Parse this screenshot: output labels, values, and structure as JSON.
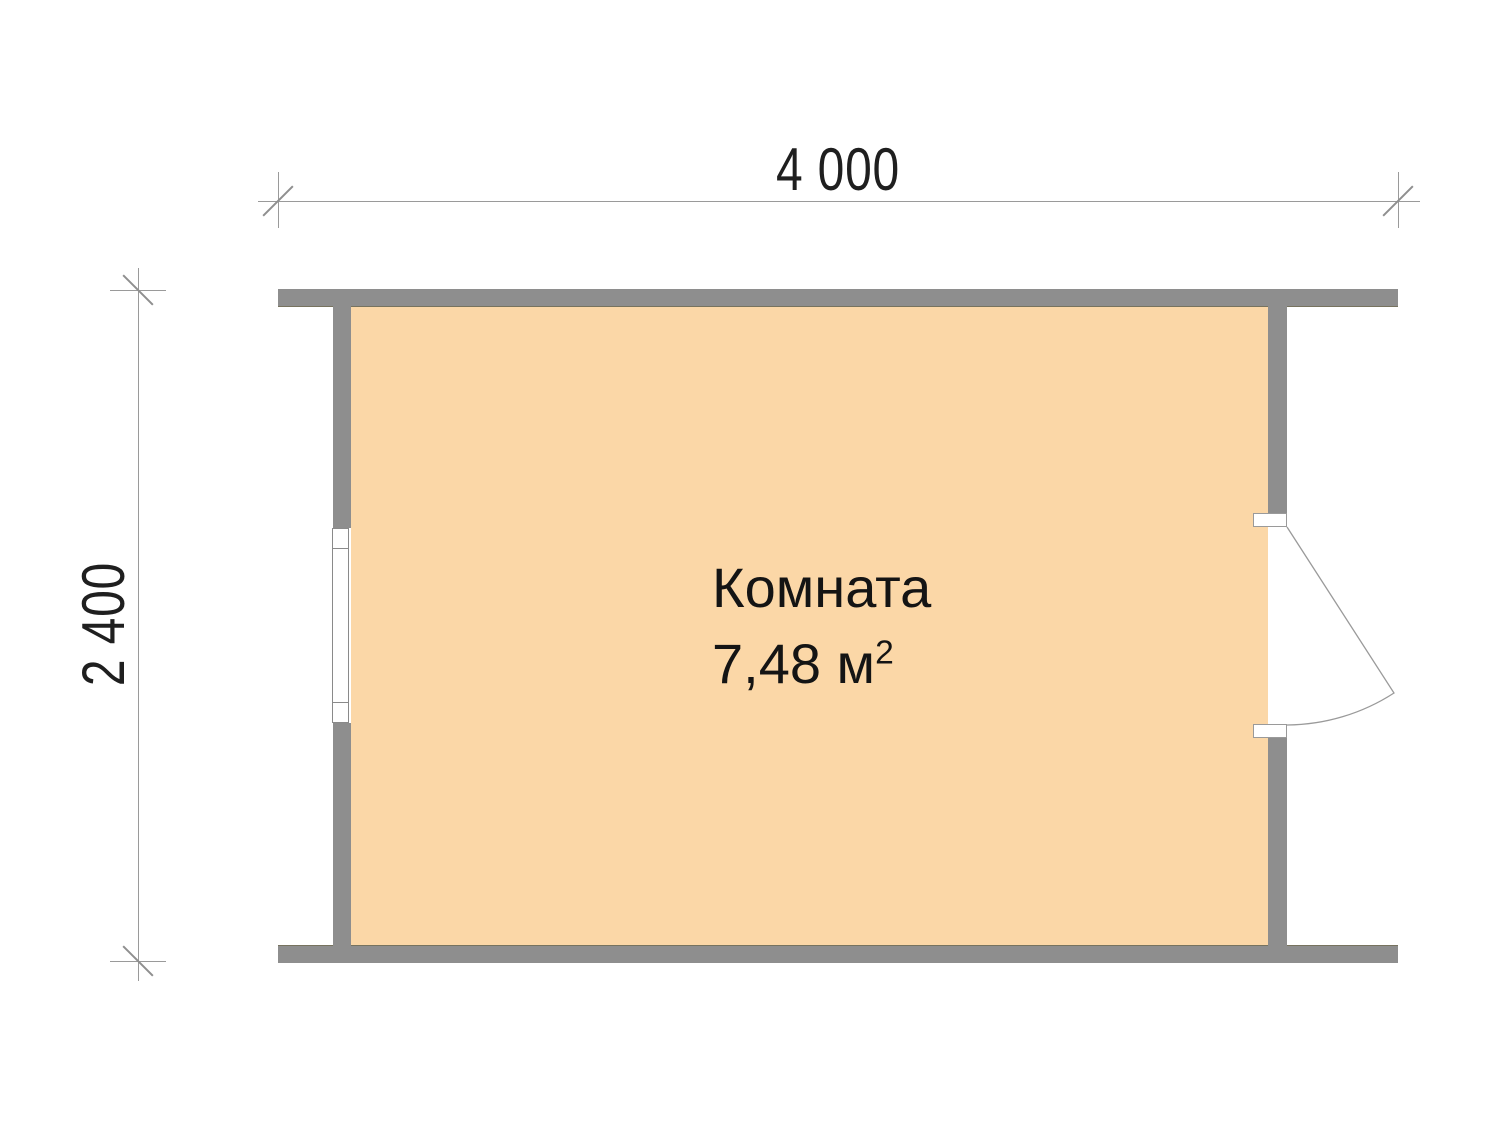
{
  "floor_plan": {
    "room": {
      "label": "Комната",
      "area": "7,48 м",
      "area_exponent": "2"
    },
    "dimensions": {
      "width": "4 000",
      "height": "2 400"
    },
    "colors": {
      "floor": "#FBD7A7",
      "wall": "#8E8E8E",
      "dimension_line": "#9A9A9A",
      "label_text": "#141414"
    },
    "symbols": {
      "window": "window-symbol",
      "door": "door-swing-symbol"
    }
  }
}
